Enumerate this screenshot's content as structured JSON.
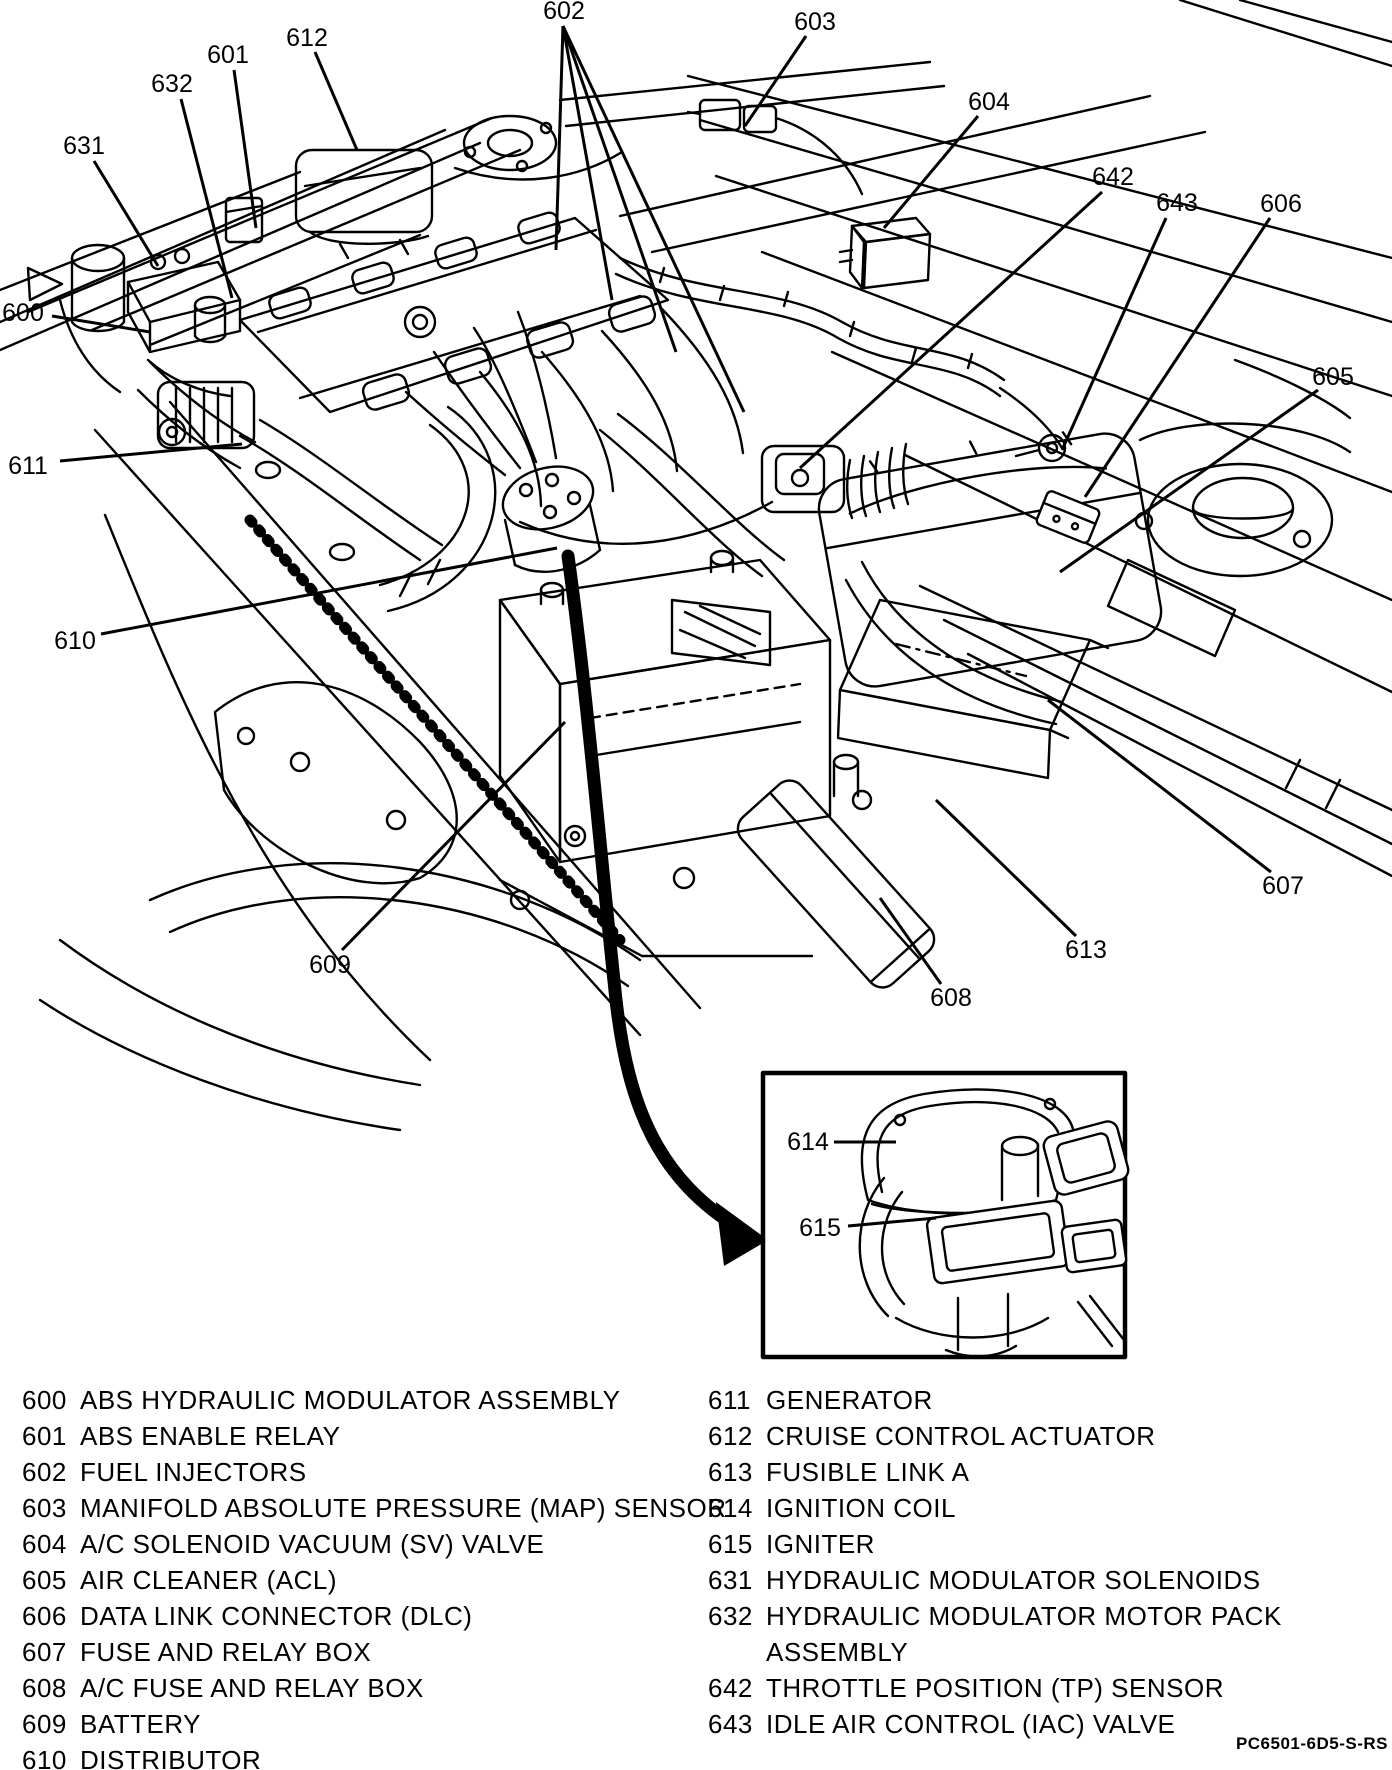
{
  "figure": {
    "footer_code": "PC6501-6D5-S-RS"
  },
  "callouts": [
    {
      "num": "600",
      "x": 23,
      "y": 313,
      "lines": [
        [
          52,
          316,
          150,
          332
        ]
      ]
    },
    {
      "num": "601",
      "x": 228,
      "y": 55,
      "lines": [
        [
          234,
          70,
          256,
          228
        ]
      ]
    },
    {
      "num": "602",
      "x": 564,
      "y": 11,
      "lines": [
        [
          563,
          26,
          556,
          250
        ],
        [
          563,
          26,
          612,
          300
        ],
        [
          563,
          26,
          676,
          352
        ],
        [
          563,
          26,
          744,
          412
        ]
      ]
    },
    {
      "num": "603",
      "x": 815,
      "y": 22,
      "lines": [
        [
          806,
          36,
          745,
          126
        ]
      ]
    },
    {
      "num": "604",
      "x": 989,
      "y": 102,
      "lines": [
        [
          978,
          116,
          884,
          228
        ]
      ]
    },
    {
      "num": "605",
      "x": 1333,
      "y": 377,
      "lines": [
        [
          1318,
          390,
          1060,
          572
        ]
      ]
    },
    {
      "num": "606",
      "x": 1281,
      "y": 204,
      "lines": [
        [
          1270,
          218,
          1085,
          497
        ]
      ]
    },
    {
      "num": "607",
      "x": 1283,
      "y": 886,
      "lines": [
        [
          1271,
          872,
          1048,
          700
        ]
      ]
    },
    {
      "num": "608",
      "x": 951,
      "y": 998,
      "lines": [
        [
          941,
          984,
          880,
          898
        ]
      ]
    },
    {
      "num": "609",
      "x": 330,
      "y": 965,
      "lines": [
        [
          342,
          950,
          565,
          722
        ]
      ]
    },
    {
      "num": "610",
      "x": 75,
      "y": 641,
      "lines": [
        [
          101,
          634,
          557,
          548
        ]
      ]
    },
    {
      "num": "611",
      "x": 28,
      "y": 466,
      "lines": [
        [
          60,
          461,
          242,
          444
        ]
      ]
    },
    {
      "num": "612",
      "x": 307,
      "y": 38,
      "lines": [
        [
          315,
          52,
          357,
          150
        ]
      ]
    },
    {
      "num": "613",
      "x": 1086,
      "y": 950,
      "lines": [
        [
          1076,
          936,
          936,
          800
        ]
      ]
    },
    {
      "num": "614",
      "x": 808,
      "y": 1142,
      "lines": [
        [
          834,
          1142,
          896,
          1142
        ]
      ]
    },
    {
      "num": "615",
      "x": 820,
      "y": 1228,
      "lines": [
        [
          848,
          1226,
          936,
          1218
        ]
      ]
    },
    {
      "num": "631",
      "x": 84,
      "y": 146,
      "lines": [
        [
          94,
          161,
          158,
          266
        ]
      ]
    },
    {
      "num": "632",
      "x": 172,
      "y": 84,
      "lines": [
        [
          181,
          99,
          232,
          298
        ]
      ]
    },
    {
      "num": "642",
      "x": 1113,
      "y": 177,
      "lines": [
        [
          1102,
          192,
          800,
          468
        ]
      ]
    },
    {
      "num": "643",
      "x": 1177,
      "y": 203,
      "lines": [
        [
          1166,
          218,
          1062,
          450
        ]
      ]
    }
  ],
  "legend": {
    "left": [
      {
        "num": "600",
        "label": "ABS HYDRAULIC MODULATOR ASSEMBLY"
      },
      {
        "num": "601",
        "label": "ABS ENABLE RELAY"
      },
      {
        "num": "602",
        "label": "FUEL INJECTORS"
      },
      {
        "num": "603",
        "label": "MANIFOLD ABSOLUTE PRESSURE (MAP) SENSOR"
      },
      {
        "num": "604",
        "label": "A/C SOLENOID VACUUM (SV) VALVE"
      },
      {
        "num": "605",
        "label": "AIR CLEANER (ACL)"
      },
      {
        "num": "606",
        "label": "DATA LINK CONNECTOR (DLC)"
      },
      {
        "num": "607",
        "label": "FUSE AND RELAY BOX"
      },
      {
        "num": "608",
        "label": "A/C FUSE AND RELAY BOX"
      },
      {
        "num": "609",
        "label": "BATTERY"
      },
      {
        "num": "610",
        "label": "DISTRIBUTOR"
      }
    ],
    "right": [
      {
        "num": "611",
        "label": "GENERATOR"
      },
      {
        "num": "612",
        "label": "CRUISE CONTROL ACTUATOR"
      },
      {
        "num": "613",
        "label": "FUSIBLE LINK A"
      },
      {
        "num": "614",
        "label": "IGNITION COIL"
      },
      {
        "num": "615",
        "label": "IGNITER"
      },
      {
        "num": "631",
        "label": "HYDRAULIC MODULATOR SOLENOIDS"
      },
      {
        "num": "632",
        "label": "HYDRAULIC MODULATOR MOTOR PACK\nASSEMBLY"
      },
      {
        "num": "642",
        "label": "THROTTLE POSITION (TP) SENSOR"
      },
      {
        "num": "643",
        "label": "IDLE AIR CONTROL (IAC) VALVE"
      }
    ]
  }
}
